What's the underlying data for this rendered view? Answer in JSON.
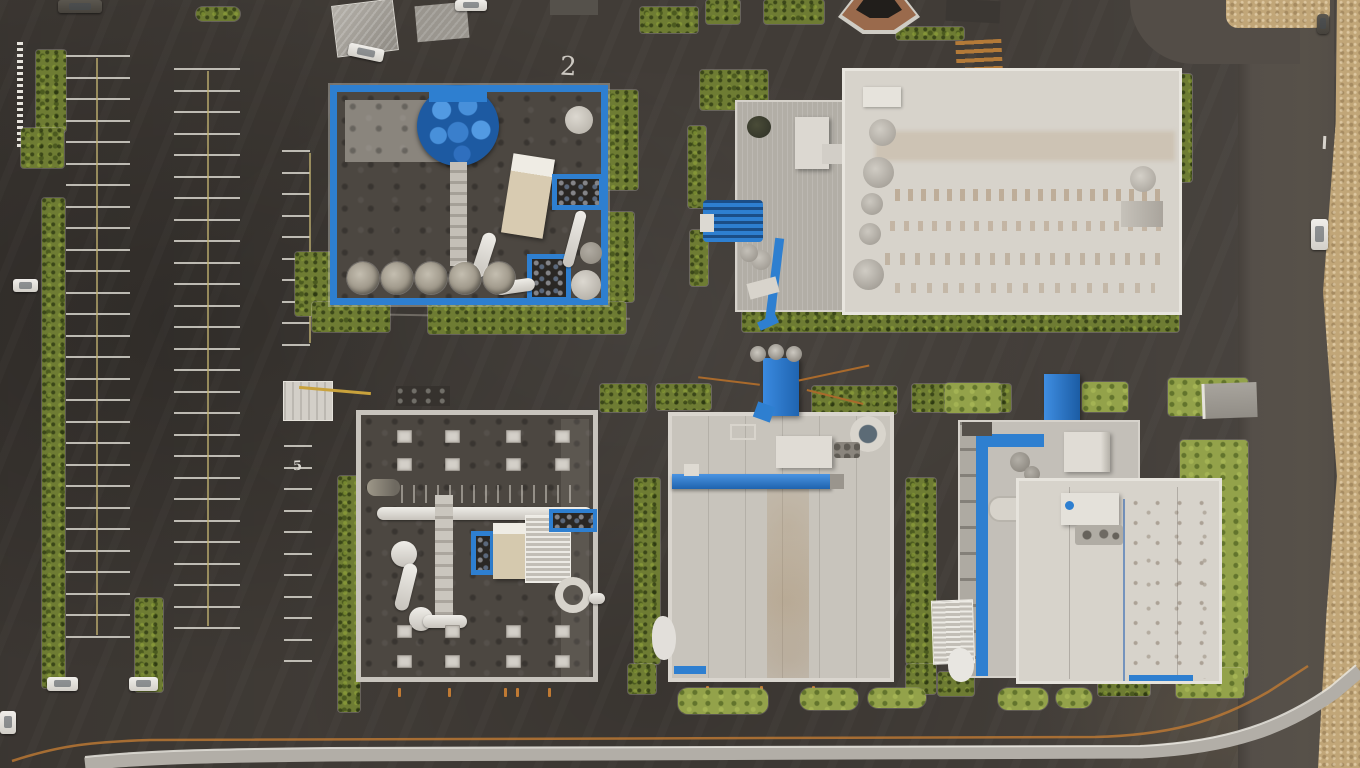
{
  "scene": {
    "description": "Aerial top-down drone photo of an industrial business park: five flat-roofed buildings with bright blue trim and rooftop equipment, large striped parking lot at left, asphalt access roads, hedge strips, a dry-grass verge along the right road and a curb-lined road along the bottom."
  },
  "colors": {
    "asphalt": "#413c37",
    "road-light": "#534d47",
    "sidewalk": "#b2aea7",
    "line-orange": "#c07a33",
    "line-white": "#eae7e0",
    "line-yellow": "#c0b170",
    "hedge": "#6e7c33",
    "grass": "#93a24a",
    "sand": "#c1a678",
    "roof-white": "#d7d3cb",
    "roof-light": "#c8c4bc",
    "roof-gray": "#b2aea6",
    "roof-dark": "#4c4741",
    "accent-blue": "#2e7fd0",
    "accent-blue-dark": "#1f5fa8",
    "equip-beige": "#d8cbb1",
    "silo-gray": "#9b9486",
    "shed-gray": "#9d9992",
    "pond-bank": "#9a6a4c",
    "pond-dark": "#211e1b",
    "car-white": "#e8e6e1"
  },
  "markings": {
    "building2_number": "2",
    "parking_stall_number": "5"
  },
  "parking": {
    "columns": [
      {
        "x": 66,
        "top": 55,
        "width": 64,
        "stripe_count": 28,
        "gap": 21.5,
        "divider_x": 96
      },
      {
        "x": 174,
        "top": 68,
        "width": 66,
        "stripe_count": 27,
        "gap": 21.5,
        "divider_x": 207
      },
      {
        "x": 282,
        "top": 150,
        "width": 28,
        "stripe_count": 10,
        "gap": 21.5,
        "divider_x": 309
      },
      {
        "x": 284,
        "top": 445,
        "width": 28,
        "stripe_count": 11,
        "gap": 21.5,
        "divider_x": null
      }
    ]
  },
  "skylights": {
    "width": 15,
    "height": 13,
    "groups": [
      {
        "xs": [
          36,
          84,
          145,
          194
        ],
        "ys": [
          15,
          43
        ]
      },
      {
        "xs": [
          36,
          84,
          145,
          194
        ],
        "ys": [
          210,
          240
        ]
      }
    ]
  },
  "silos": {
    "y": 170,
    "radius": 16,
    "xs": [
      10,
      44,
      78,
      112,
      146
    ]
  },
  "dock_ticks": {
    "building3": {
      "y": 688,
      "xs": [
        398,
        448,
        504,
        516,
        548
      ]
    },
    "building4": {
      "y": 686,
      "xs": [
        706,
        760,
        812
      ]
    }
  },
  "green_patches_bottom": [
    [
      678,
      688,
      90,
      26
    ],
    [
      800,
      688,
      58,
      22
    ],
    [
      868,
      688,
      58,
      20
    ],
    [
      998,
      688,
      50,
      22
    ],
    [
      1056,
      688,
      36,
      20
    ]
  ],
  "vehicles": {
    "white_cars": 7,
    "dark_vehicles": 2
  }
}
